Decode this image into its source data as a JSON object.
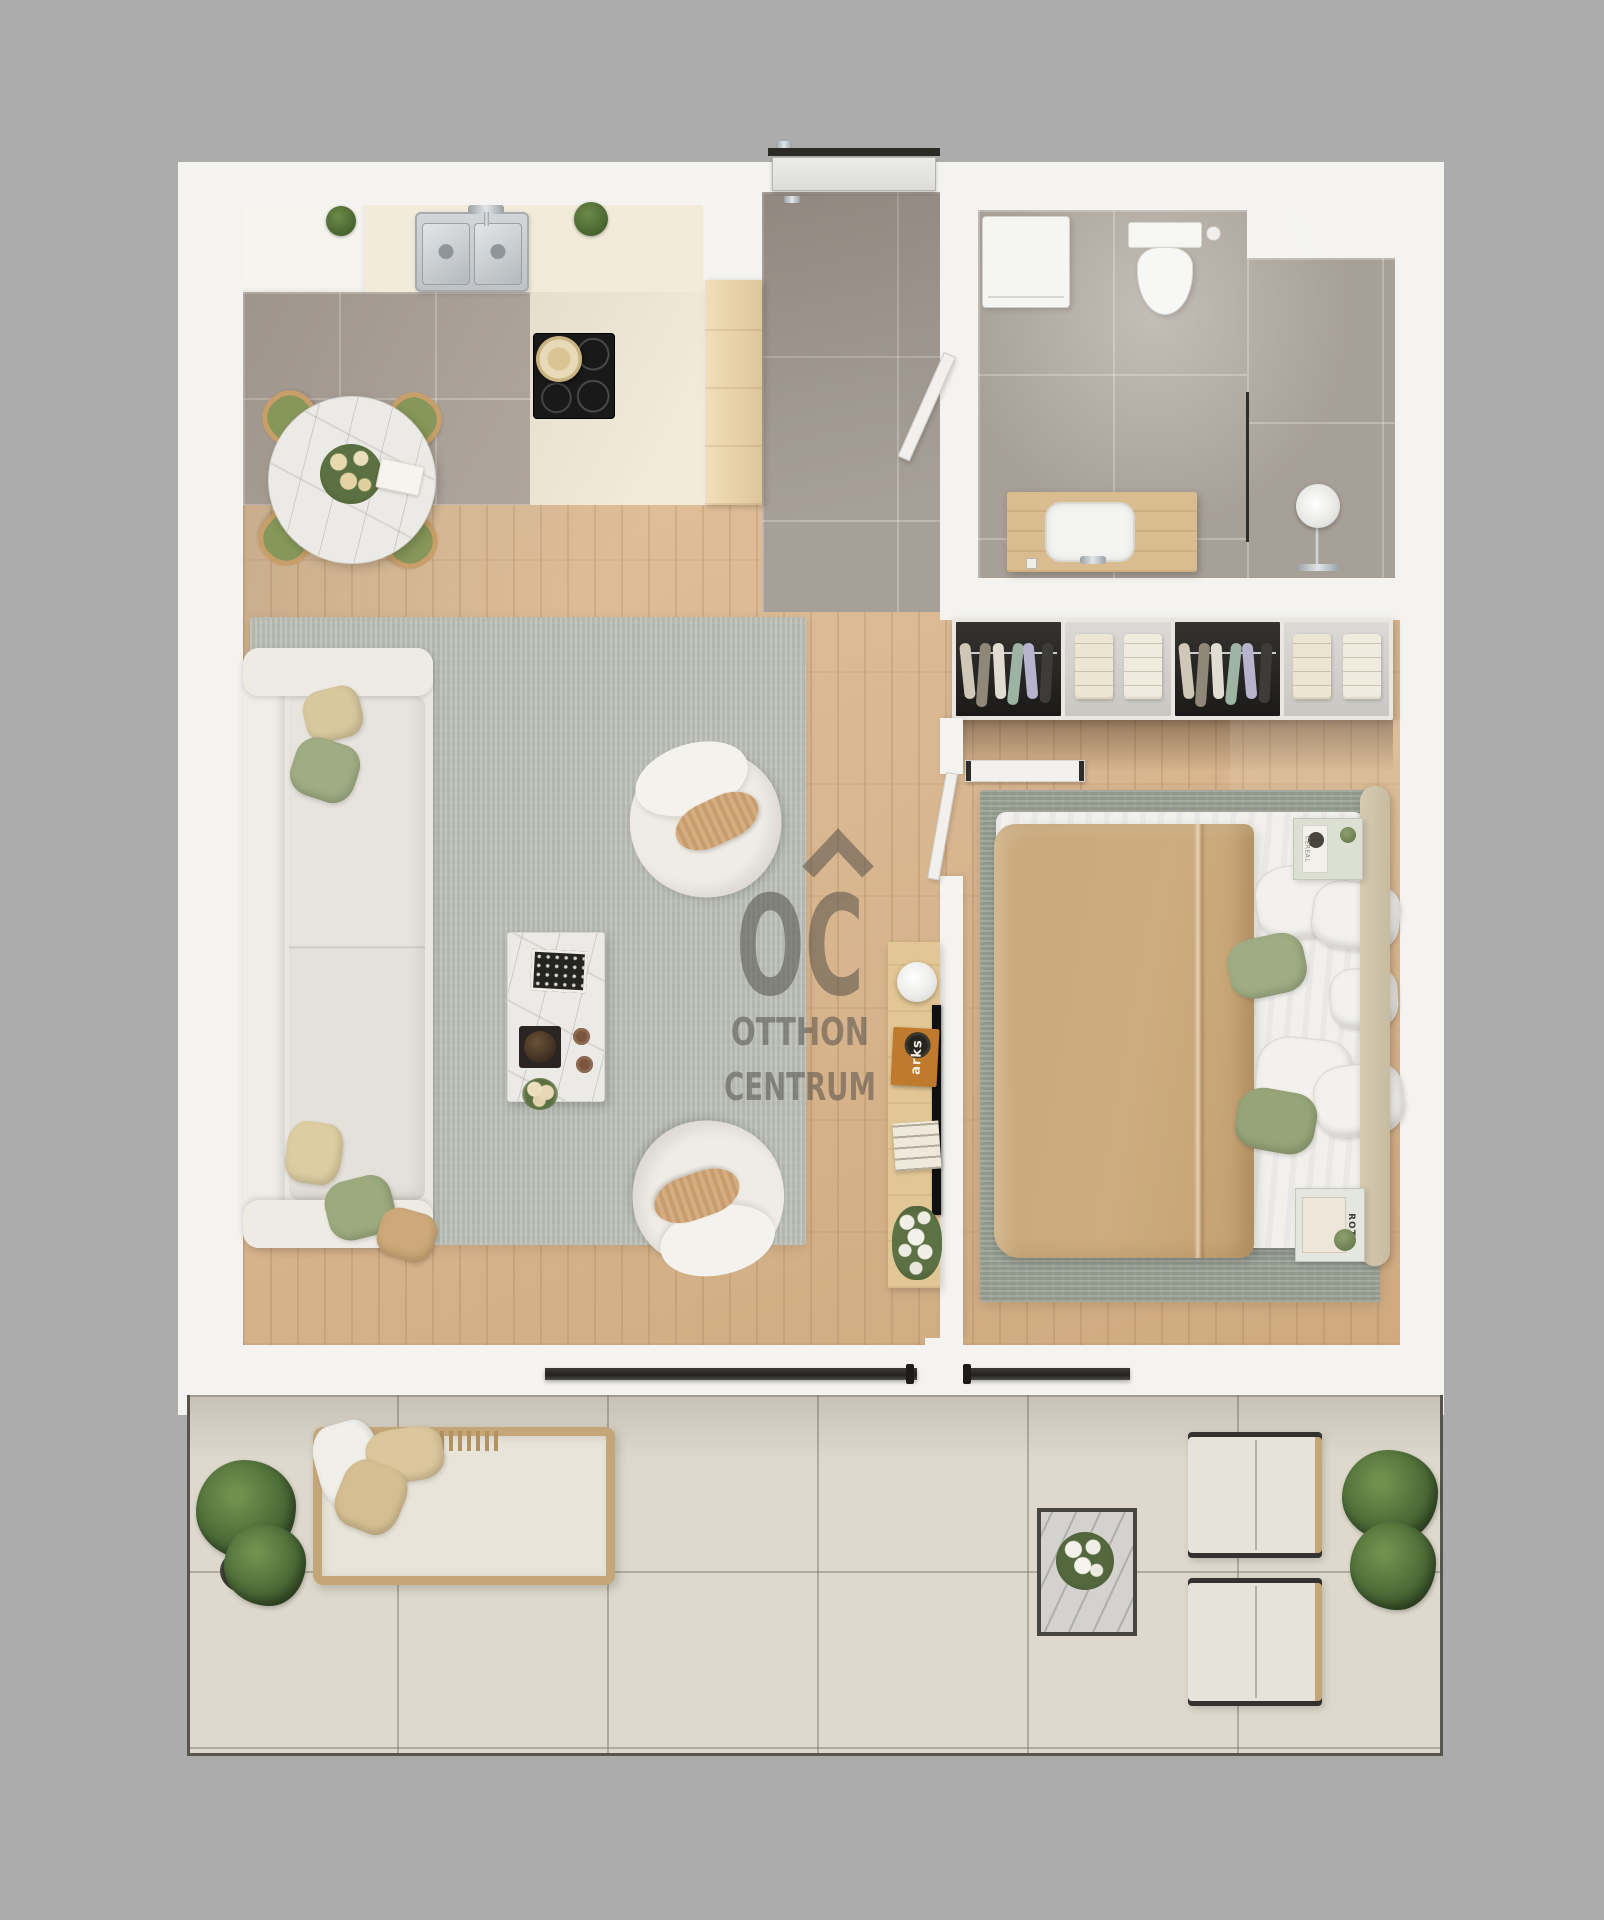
{
  "meta": {
    "type": "floor-plan-render",
    "view": "top-down",
    "brand": "Otthon Centrum"
  },
  "watermark": {
    "logo": "OC",
    "line1": "OTTHON",
    "line2": "CENTRUM",
    "color": "#4a4845",
    "roof_icon": "roof-icon"
  },
  "texts": {
    "console_book_spine": "arks",
    "nightstand_magazine_top": "CEREAL",
    "nightstand_magazine_bottom": "ROT"
  },
  "palette": {
    "background": "#acacac",
    "wall": "#f4f3f0",
    "wood_floor": "#d7b48c",
    "kitchen_tile": "#b2a9a1",
    "bath_tile": "#a7a098",
    "terrace_tile": "#ded9cc",
    "living_rug": "#b9bdb4",
    "bedroom_rug": "#99a095",
    "counter_cream": "#f2ebd9",
    "sofa_cream": "#eae7e1",
    "accent_green": "#9dab81",
    "accent_tan": "#cfa878",
    "blanket_tan": "#c9a97d",
    "cooktop_black": "#191919",
    "steel": "#c9cdd0",
    "furniture_wood": "#e2c695",
    "frame_dark": "#2c2b28",
    "plant_green": "#50703a"
  },
  "rooms": [
    {
      "id": "kitchen-dining",
      "furniture": [
        "double-sink",
        "induction-cooktop",
        "pot",
        "cream-counter",
        "round-marble-dining-table",
        "dining-chairs-x4",
        "bouquet",
        "open-book",
        "potted-plants-x2"
      ]
    },
    {
      "id": "entry-hall",
      "furniture": [
        "entrance-door",
        "tall-wood-cabinet",
        "bathroom-door"
      ]
    },
    {
      "id": "bathroom",
      "furniture": [
        "washing-machine",
        "wall-hung-toilet",
        "toilet-brush",
        "shower-glass-partition",
        "shower-column",
        "wood-vanity",
        "vessel-sink",
        "faucet",
        "socket"
      ]
    },
    {
      "id": "wardrobe-row",
      "furniture": [
        "hanging-rail-section-x2",
        "folded-shelf-section-x2",
        "wall-shelf"
      ]
    },
    {
      "id": "living-room",
      "furniture": [
        "sofa",
        "throw-pillows-x5",
        "marble-coffee-table",
        "decor-tray",
        "bowl",
        "cups",
        "flowers",
        "boucle-armchairs-x2",
        "area-rug",
        "tv",
        "media-console",
        "sphere-lamp",
        "orange-book",
        "book-stack",
        "vase-flowers"
      ]
    },
    {
      "id": "bedroom",
      "furniture": [
        "double-bed",
        "tan-blanket",
        "white-pillows-x5",
        "green-pillows-x2",
        "wood-headboard",
        "nightstand-x2",
        "magazines",
        "candle",
        "area-rug",
        "bedroom-door"
      ]
    },
    {
      "id": "terrace",
      "furniture": [
        "rattan-daybed",
        "daybed-pillows-x3",
        "lounge-chairs-x2",
        "marble-side-table",
        "rose-bouquet",
        "potted-plants-x2",
        "sliding-glass-doors-x2"
      ]
    }
  ]
}
